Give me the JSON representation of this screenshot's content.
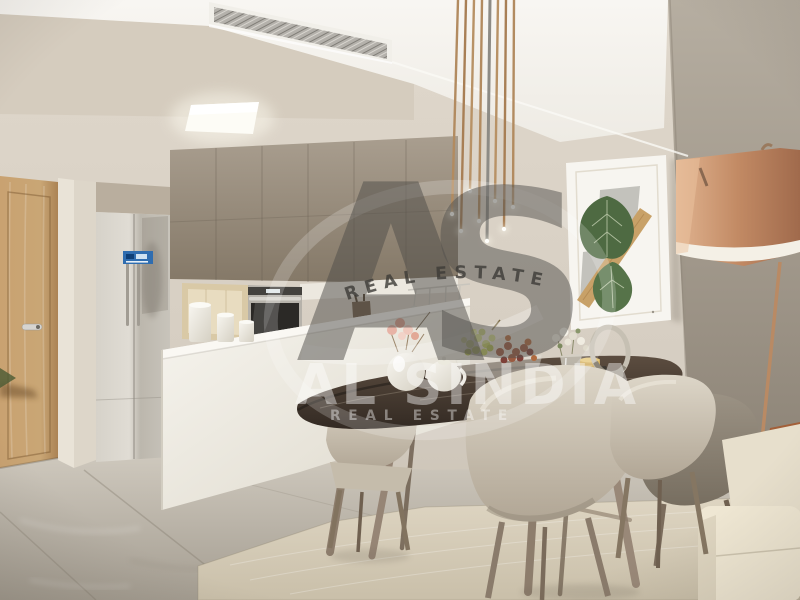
{
  "watermark": {
    "monogram": "AS",
    "arc_text": "REAL ESTATE",
    "brand_name": "AL SINDIA",
    "brand_tagline": "REAL ESTATE"
  },
  "palette": {
    "ceiling_white": "#f6f4ef",
    "wall_back": "#d9d1c5",
    "wall_right": "#a59c8f",
    "cabinet_taupe": "#95897a",
    "island_white": "#f2efe8",
    "door_oak": "#c49e6b",
    "floor_marble": "#c6c0b5",
    "rug_beige": "#d8cfbc",
    "table_marble": "#46392f",
    "chair_fabric": "#cfc7b7",
    "lamp_copper": "#c08a66",
    "pendant_brass": "#b08a62",
    "leaf_green": "#4f6a43",
    "sofa_cream": "#ebe3d0",
    "pillow_rust": "#9a5833",
    "fridge_steel": "#c9c5bc",
    "fridge_sticker_blue": "#2f6db0",
    "wood_legs": "#8d7d6c"
  }
}
